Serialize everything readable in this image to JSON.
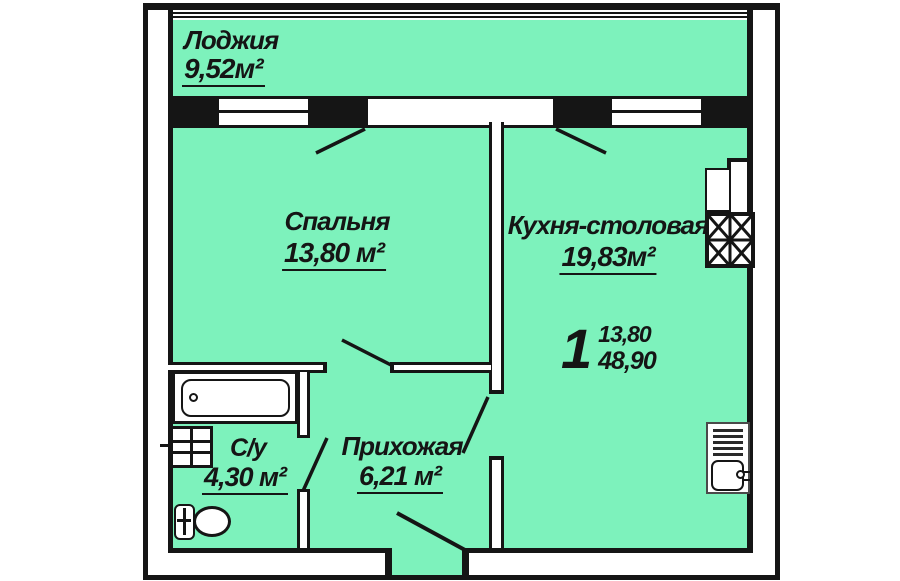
{
  "plan": {
    "rooms": [
      {
        "name": "Лоджия",
        "area": "9,52м²"
      },
      {
        "name": "Спальня",
        "area": "13,80 м²"
      },
      {
        "name": "Кухня-столовая",
        "area": "19,83м²"
      },
      {
        "name": "С/у",
        "area": "4,30 м²"
      },
      {
        "name": "Прихожая",
        "area": "6,21 м²"
      }
    ],
    "apartment_stamp": {
      "rooms_count": "1",
      "living_area": "13,80",
      "total_area": "48,90"
    },
    "colors": {
      "floor_fill": "#7df2bc",
      "wall": "#151515",
      "background": "#ffffff"
    },
    "fixtures": [
      "bathtub-icon",
      "washbasin-icon",
      "toilet-icon",
      "fridge-icon",
      "vent-shaft-icon",
      "stove-icon",
      "kitchen-sink-icon",
      "window",
      "door-swing"
    ]
  }
}
